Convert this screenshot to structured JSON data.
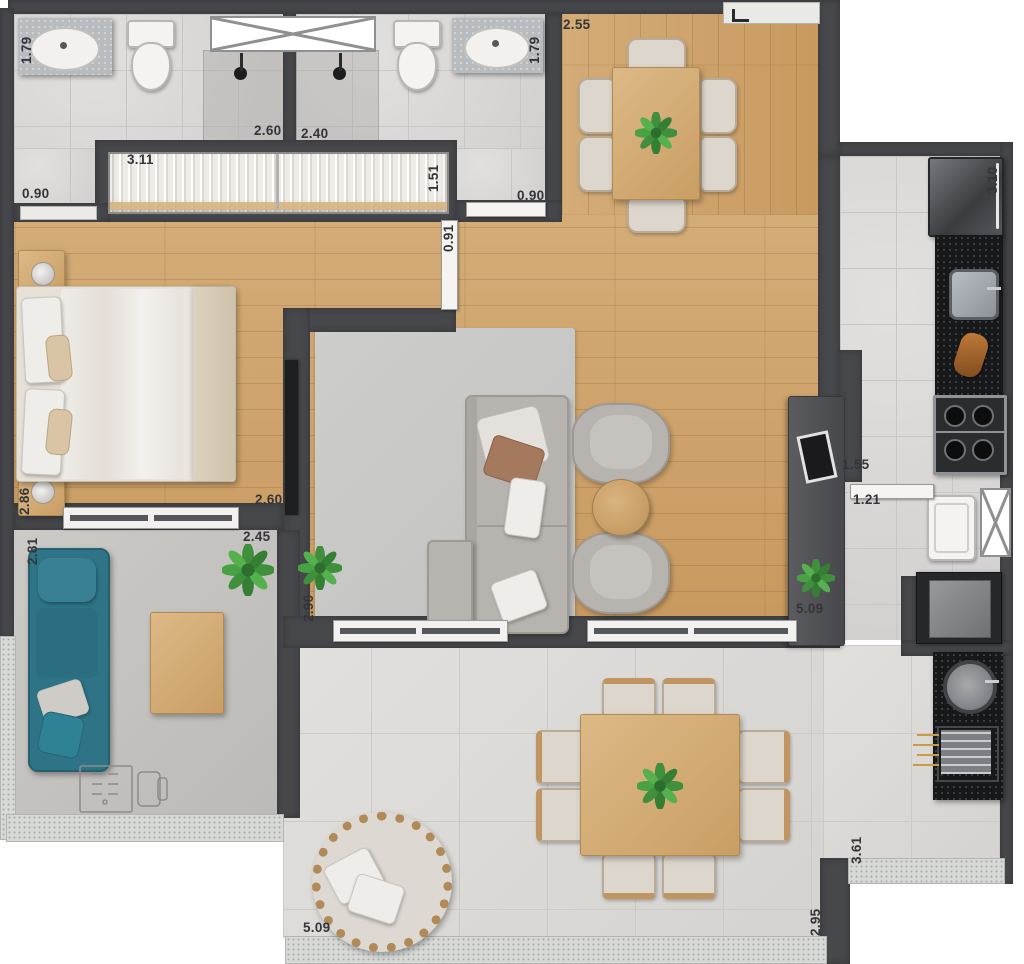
{
  "meta": {
    "kind": "apartment-floor-plan-top-view",
    "units": "meters"
  },
  "palette": {
    "wall": "#47484b",
    "wood_floor": "#cfa671",
    "bath_tile": "#dad8d6",
    "balcony_tile": "#dddbd8",
    "black_counter": "#17181a",
    "teal_sofa": "#2e7486",
    "gray_sofa": "#b7b3ae",
    "plant_green": "#3e8f3e",
    "label_color": "#34353a"
  },
  "dimension_labels": [
    {
      "text": "1.79",
      "x": 20,
      "y": 64,
      "rotated": true
    },
    {
      "text": "2.60",
      "x": 254,
      "y": 124,
      "rotated": false
    },
    {
      "text": "2.40",
      "x": 301,
      "y": 127,
      "rotated": false
    },
    {
      "text": "1.79",
      "x": 528,
      "y": 64,
      "rotated": true
    },
    {
      "text": "2.55",
      "x": 563,
      "y": 18,
      "rotated": false
    },
    {
      "text": "3.11",
      "x": 127,
      "y": 153,
      "rotated": false
    },
    {
      "text": "1.51",
      "x": 427,
      "y": 192,
      "rotated": true
    },
    {
      "text": "0.90",
      "x": 22,
      "y": 187,
      "rotated": false
    },
    {
      "text": "0.90",
      "x": 517,
      "y": 189,
      "rotated": false
    },
    {
      "text": "0.91",
      "x": 442,
      "y": 252,
      "rotated": true
    },
    {
      "text": "3.10",
      "x": 986,
      "y": 194,
      "rotated": true
    },
    {
      "text": "2.86",
      "x": 18,
      "y": 515,
      "rotated": true
    },
    {
      "text": "2.60",
      "x": 255,
      "y": 493,
      "rotated": false
    },
    {
      "text": "2.81",
      "x": 26,
      "y": 565,
      "rotated": true
    },
    {
      "text": "2.45",
      "x": 243,
      "y": 530,
      "rotated": false
    },
    {
      "text": "2.90",
      "x": 302,
      "y": 622,
      "rotated": true
    },
    {
      "text": "1.55",
      "x": 842,
      "y": 458,
      "rotated": false
    },
    {
      "text": "1.21",
      "x": 853,
      "y": 493,
      "rotated": false
    },
    {
      "text": "5.09",
      "x": 796,
      "y": 602,
      "rotated": false
    },
    {
      "text": "5.09",
      "x": 303,
      "y": 921,
      "rotated": false
    },
    {
      "text": "3.61",
      "x": 850,
      "y": 864,
      "rotated": true
    },
    {
      "text": "2.95",
      "x": 809,
      "y": 936,
      "rotated": true
    }
  ]
}
